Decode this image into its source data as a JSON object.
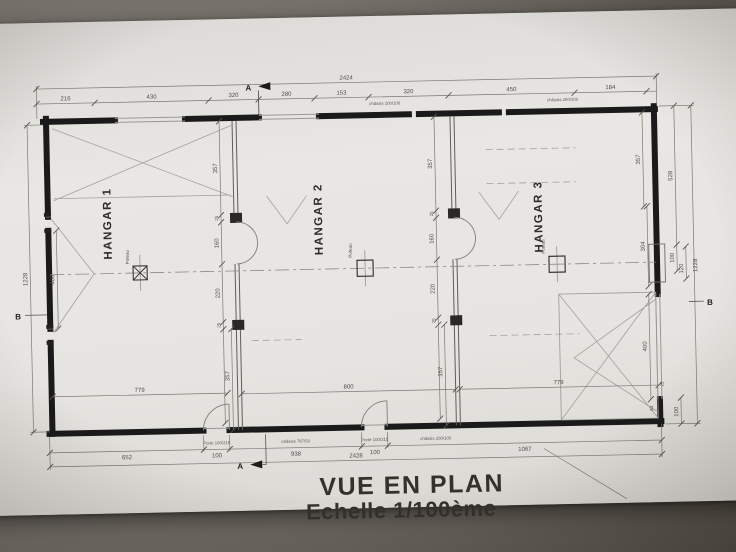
{
  "title": {
    "line1": "VUE EN PLAN",
    "line2": "Echelle 1/100ème"
  },
  "rooms": [
    {
      "label": "HANGAR 1"
    },
    {
      "label": "HANGAR 2"
    },
    {
      "label": "HANGAR 3"
    }
  ],
  "section_markers": {
    "a": "A",
    "b": "B"
  },
  "dims": {
    "top_overall": "2424",
    "top_segments": [
      "216",
      "430",
      "320",
      "280",
      "153",
      "320",
      "450",
      "184"
    ],
    "bottom_segments": [
      "652",
      "100",
      "938",
      "100",
      "1067"
    ],
    "bottom_overall": "2428",
    "left_overall": "1228",
    "left_inner": "400",
    "right_overall": "1228",
    "right_chain": {
      "c357": "357",
      "c528": "528",
      "c304": "304",
      "c100": "100",
      "c120": "120",
      "c400": "400",
      "c25": "25",
      "c84": "84",
      "c100b": "100"
    },
    "partition_chain": [
      "357",
      "25",
      "160",
      "220",
      "25",
      "357"
    ],
    "hangar_widths": [
      "779",
      "800",
      "779"
    ]
  },
  "annotations": {
    "porte": "Porte 100/215",
    "chassis_787": "châssis 787/50",
    "chassis_200": "châssis 200/100",
    "poteau": "Poteau"
  },
  "colors": {
    "wall": "#1a1a1a",
    "line": "#777470",
    "paper": "#e8e6e2",
    "background": "#6e6963"
  }
}
